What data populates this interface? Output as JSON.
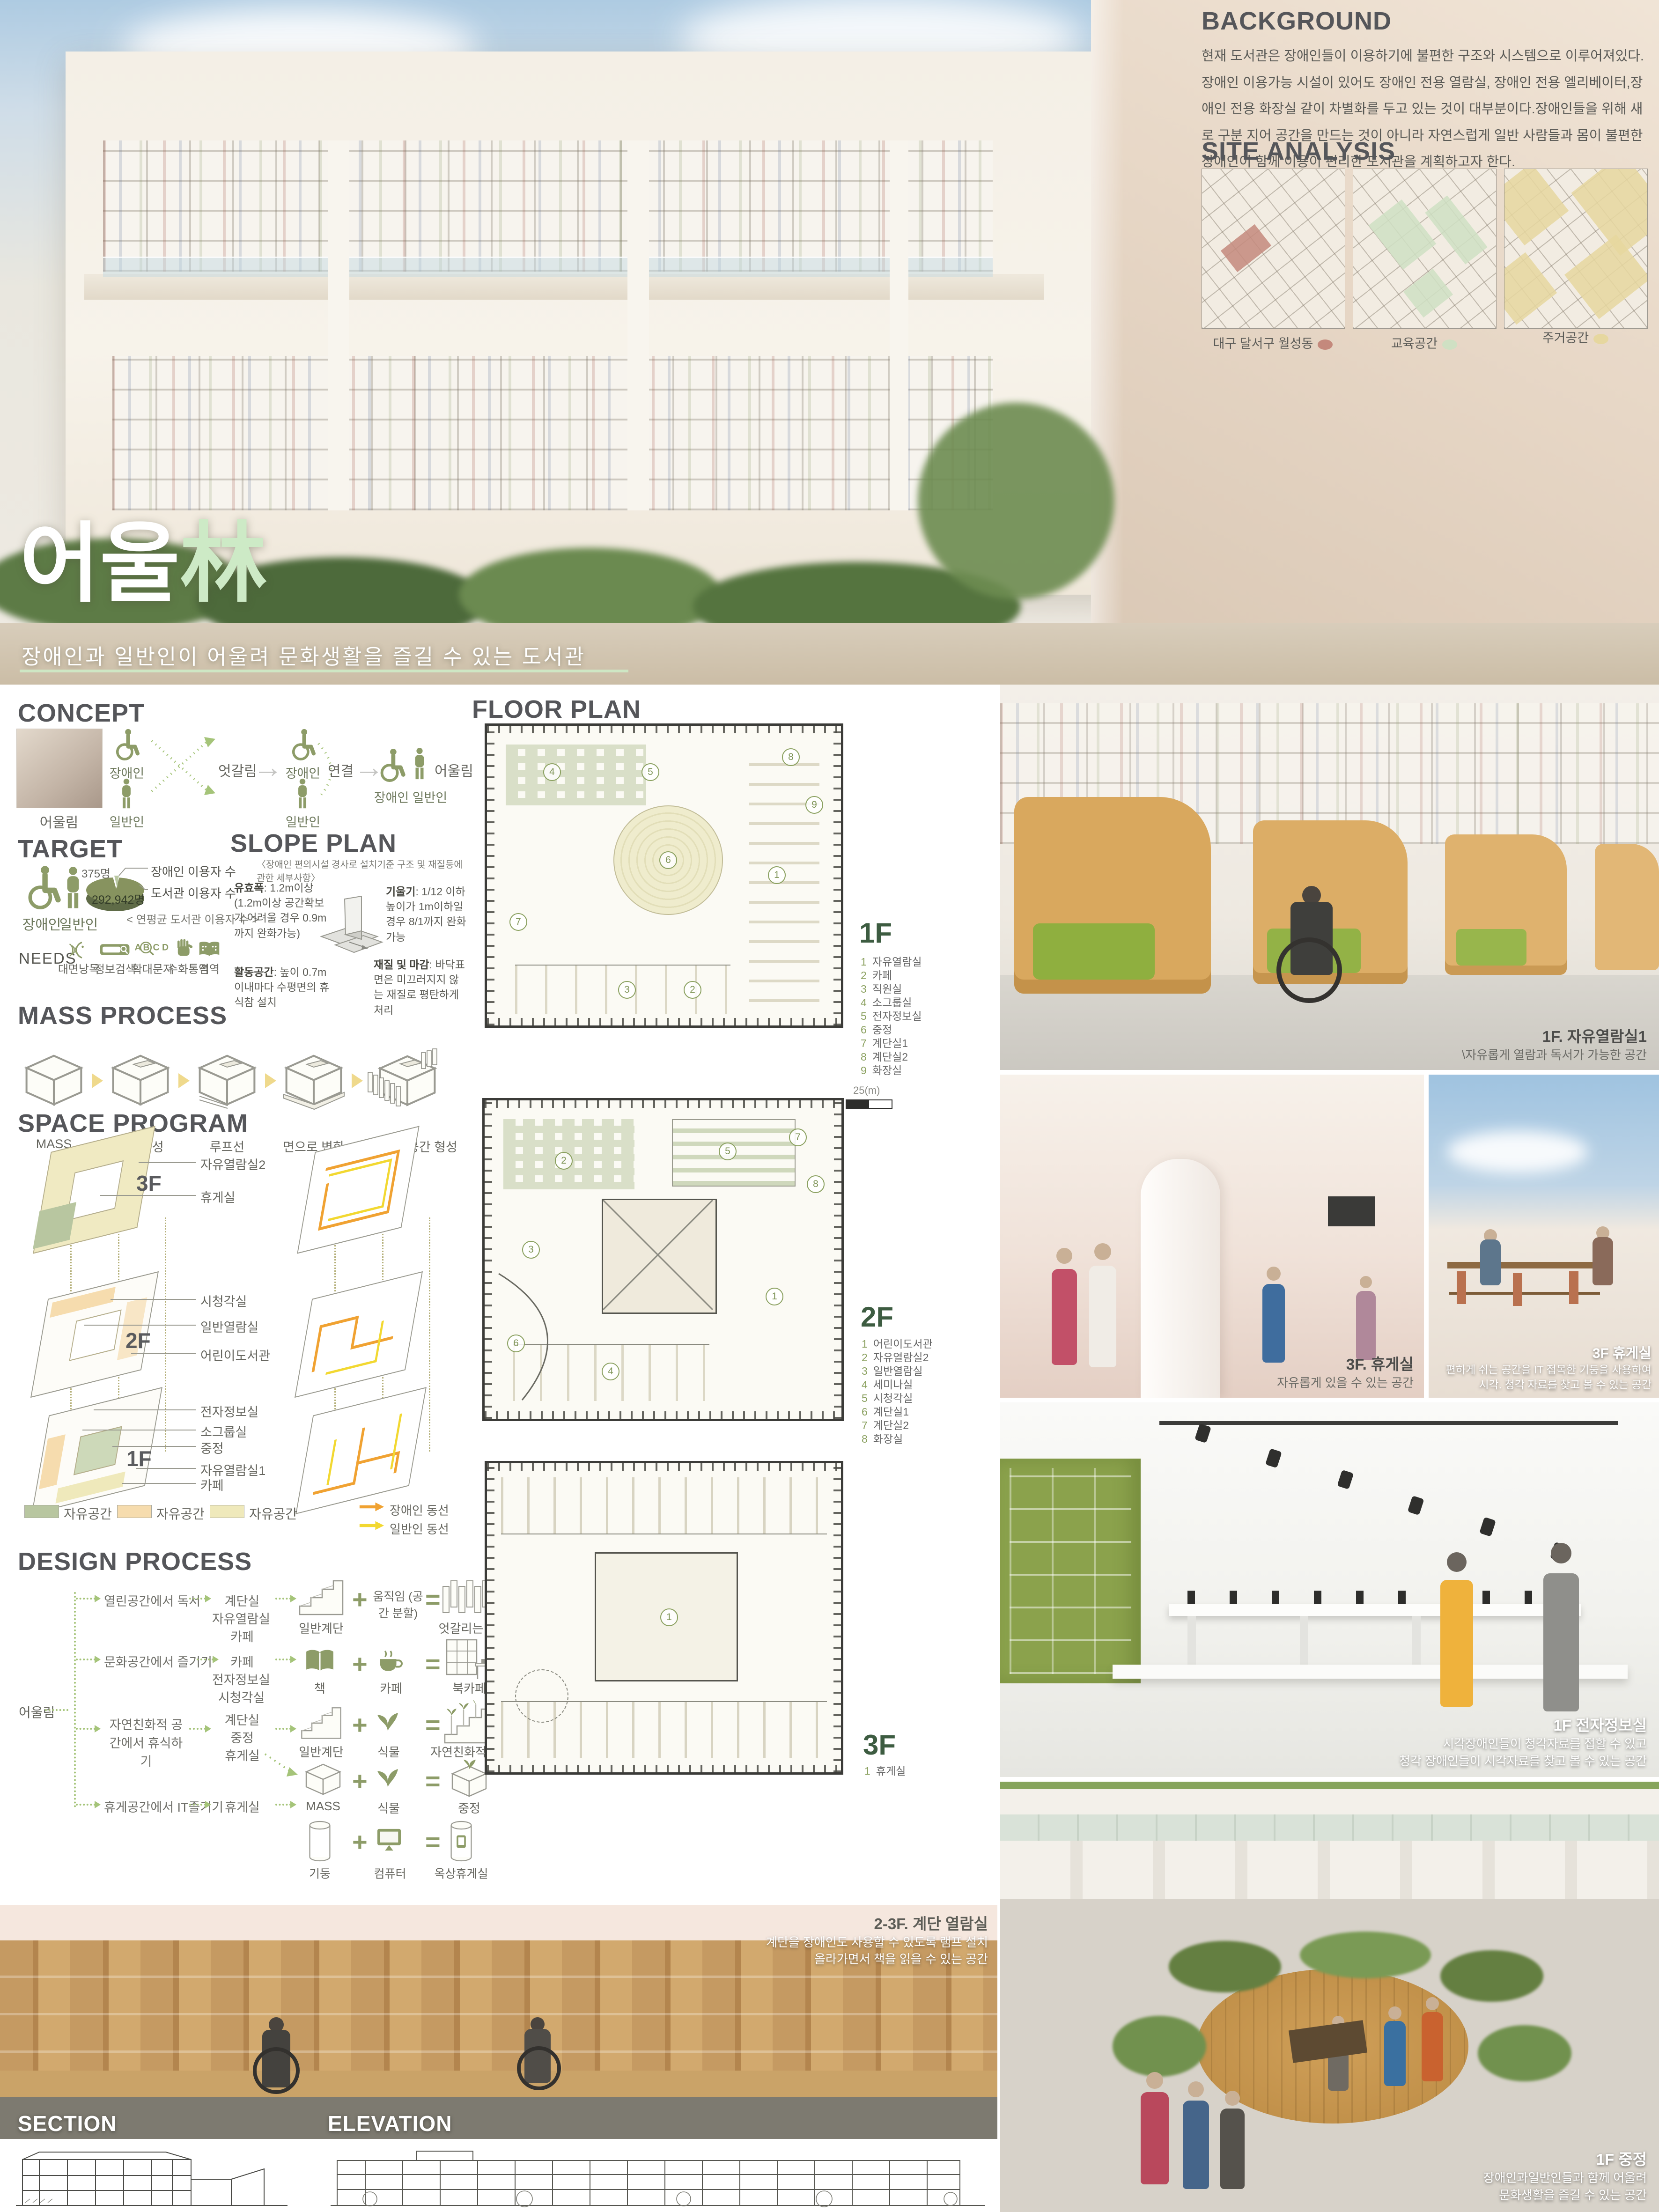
{
  "board": {
    "title": {
      "korean": "어울",
      "hanja": "林",
      "subtitle": "장애인과 일반인이 어울려 문화생활을 즐길 수 있는 도서관"
    },
    "accent_green": "#cdeac6",
    "olive": "#8d9c68"
  },
  "background": {
    "heading": "BACKGROUND",
    "body": "현재 도서관은 장애인들이 이용하기에 불편한 구조와 시스템으로 이루어져있다. 장애인 이용가능 시설이 있어도 장애인 전용 열람실, 장애인 전용 엘리베이터,장애인 전용 화장실 같이 차별화를 두고 있는 것이 대부분이다.장애인들을 위해 새로 구분 지어 공간을 만드는 것이 아니라 자연스럽게 일반 사람들과 몸이 불편한 장애인이 함께 이용이 편리한 도서관을 계획하고자 한다."
  },
  "site_analysis": {
    "heading": "SITE ANALYSIS",
    "maps": [
      {
        "label": "대구 달서구 월성동",
        "dot_color": "#c4897c"
      },
      {
        "label": "교육공간",
        "dot_color": "#cfe0c3"
      },
      {
        "label": "주거공간",
        "dot_color": "#e6d79f"
      }
    ]
  },
  "concept": {
    "heading": "CONCEPT",
    "photo_label": "어울림",
    "group1": {
      "top": "장애인",
      "bottom": "일반인"
    },
    "cross_label": "엇갈림",
    "group2": {
      "top": "장애인",
      "bottom": "일반인"
    },
    "link_label": "연결",
    "group3": {
      "side": "어울림",
      "bottom": "장애인  일반인"
    }
  },
  "target": {
    "heading": "TARGET",
    "icon1": "장애인",
    "icon2": "일반인",
    "pie": {
      "small_value": "375명",
      "large_value": "292,942명",
      "small_label": "장애인 이용자 수",
      "large_label": "도서관 이용자 수",
      "caption": "< 연평균 도서관  이용자 수 >"
    },
    "needs": {
      "label": "NEEDS",
      "items": [
        {
          "icon": "speech-waves-icon",
          "label": "대면낭독"
        },
        {
          "icon": "search-bar-icon",
          "label": "정보검색"
        },
        {
          "icon": "magnify-text-icon",
          "label": "확대문자"
        },
        {
          "icon": "hand-icon",
          "label": "수화통역"
        },
        {
          "icon": "braille-book-icon",
          "label": "점역"
        }
      ]
    }
  },
  "slope_plan": {
    "heading": "SLOPE PLAN",
    "note": "〈장애인  편의시설 경사로 설치기준 구조 및 재질등에 관한 세부사항〉",
    "items": [
      {
        "term": "유효폭",
        "desc": ": 1.2m이상 (1.2m이상 공간확보가 어려울 경우 0.9m까지 완화가능)"
      },
      {
        "term": "기울기",
        "desc": ": 1/12 이하 높이가 1m이하일 경우 8/1까지 완화가능"
      },
      {
        "term": "활동공간",
        "desc": ": 높이 0.7m 이내마다 수평면의 휴식참 설치"
      },
      {
        "term": "재질 및 마감",
        "desc": ": 바닥표면은 미끄러지지 않는 재질로 평탄하게 처리"
      }
    ]
  },
  "mass_process": {
    "heading": "MASS PROCESS",
    "steps": [
      "MASS",
      "중정형성",
      "루프선",
      "면으로 변화",
      "엇갈리게 공간 형성"
    ]
  },
  "space_program": {
    "heading": "SPACE PROGRAM",
    "floors": [
      {
        "label": "3F",
        "rooms": [
          "자유열람실2",
          "휴게실"
        ]
      },
      {
        "label": "2F",
        "rooms": [
          "시청각실",
          "일반열람실",
          "어린이도서관"
        ]
      },
      {
        "label": "1F",
        "rooms": [
          "전자정보실",
          "소그룹실",
          "중정",
          "자유열람실1",
          "카페"
        ]
      }
    ],
    "legend": [
      {
        "label": "자유공간",
        "color": "#b8c6a0"
      },
      {
        "label": "자유공간",
        "color": "#f6dcae"
      },
      {
        "label": "자유공간",
        "color": "#efe9bb"
      }
    ],
    "flow_legend": [
      {
        "label": "장애인 동선",
        "color": "#f0a232"
      },
      {
        "label": "일반인 동선",
        "color": "#f2d831"
      }
    ]
  },
  "design_process": {
    "heading": "DESIGN PROCESS",
    "root": "어울림",
    "branches": [
      {
        "activity": "열린공간에서 독서",
        "spaces": [
          "계단실",
          "자유열람실",
          "카페"
        ],
        "a": "일반계단",
        "b": "움직임 (공간 분할)",
        "result": "엇갈리는 층"
      },
      {
        "activity": "문화공간에서 즐기기",
        "spaces": [
          "카페",
          "전자정보실",
          "시청각실"
        ],
        "a": "책",
        "b": "카페",
        "result": "북카페"
      },
      {
        "activity": "자연친화적 공간에서 휴식하기",
        "spaces": [
          "계단실",
          "중정",
          "휴게실"
        ],
        "a": "일반계단",
        "b": "식물",
        "result": "자연친화적계단",
        "a2": "MASS",
        "b2": "식물",
        "result2": "중정"
      },
      {
        "activity": "휴게공간에서 IT즐기기",
        "spaces": [
          "휴게실"
        ],
        "a": "기둥",
        "b": "컴퓨터",
        "result": "옥상휴게실"
      }
    ]
  },
  "floor_plan": {
    "heading": "FLOOR PLAN",
    "scale_label": "25(m)",
    "floors": [
      {
        "label": "1F",
        "rooms": [
          {
            "num": "1",
            "name": "자유열람실"
          },
          {
            "num": "2",
            "name": "카페"
          },
          {
            "num": "3",
            "name": "직원실"
          },
          {
            "num": "4",
            "name": "소그룹실"
          },
          {
            "num": "5",
            "name": "전자정보실"
          },
          {
            "num": "6",
            "name": "중정"
          },
          {
            "num": "7",
            "name": "계단실1"
          },
          {
            "num": "8",
            "name": "계단실2"
          },
          {
            "num": "9",
            "name": "화장실"
          }
        ]
      },
      {
        "label": "2F",
        "rooms": [
          {
            "num": "1",
            "name": "어린이도서관"
          },
          {
            "num": "2",
            "name": "자유열람실2"
          },
          {
            "num": "3",
            "name": "일반열람실"
          },
          {
            "num": "4",
            "name": "세미나실"
          },
          {
            "num": "5",
            "name": "시청각실"
          },
          {
            "num": "6",
            "name": "계단실1"
          },
          {
            "num": "7",
            "name": "계단실2"
          },
          {
            "num": "8",
            "name": "화장실"
          }
        ]
      },
      {
        "label": "3F",
        "rooms": [
          {
            "num": "1",
            "name": "휴게실"
          }
        ]
      }
    ]
  },
  "photos": [
    {
      "title": "1F. 자유열람실1",
      "line1": "\\자유롭게 열람과 독서가 가능한 공간",
      "line2": ""
    },
    {
      "title": "3F. 휴게실",
      "line1": "자유롭게 있을 수 있는 공간",
      "line2": ""
    },
    {
      "title": "3F 휴게실",
      "line1": "편하게 쉬는 공간을 IT 접목한 기둥을 사용하여",
      "line2": "시각. 청각 자료를 찾고 볼 수 있는 공간"
    },
    {
      "title": "1F 전자정보실",
      "line1": "시각장애인들이 청각자료를 접할 수 있고",
      "line2": "청각 장애인들이 시각자료를 찾고 볼 수 있는 공간"
    },
    {
      "title": "2-3F. 계단 열람실",
      "line1": "계단을 장애인도 사용할 수 있도록 램프 설치",
      "line2": "올라가면서 책을 읽을 수 있는 공간"
    },
    {
      "title": "1F 중정",
      "line1": "장애인과일반인들과 함께 어울려",
      "line2": "문화생활을 즐길 수 있는 공간"
    }
  ],
  "drawings": {
    "section_heading": "SECTION",
    "elevation_heading": "ELEVATION"
  }
}
